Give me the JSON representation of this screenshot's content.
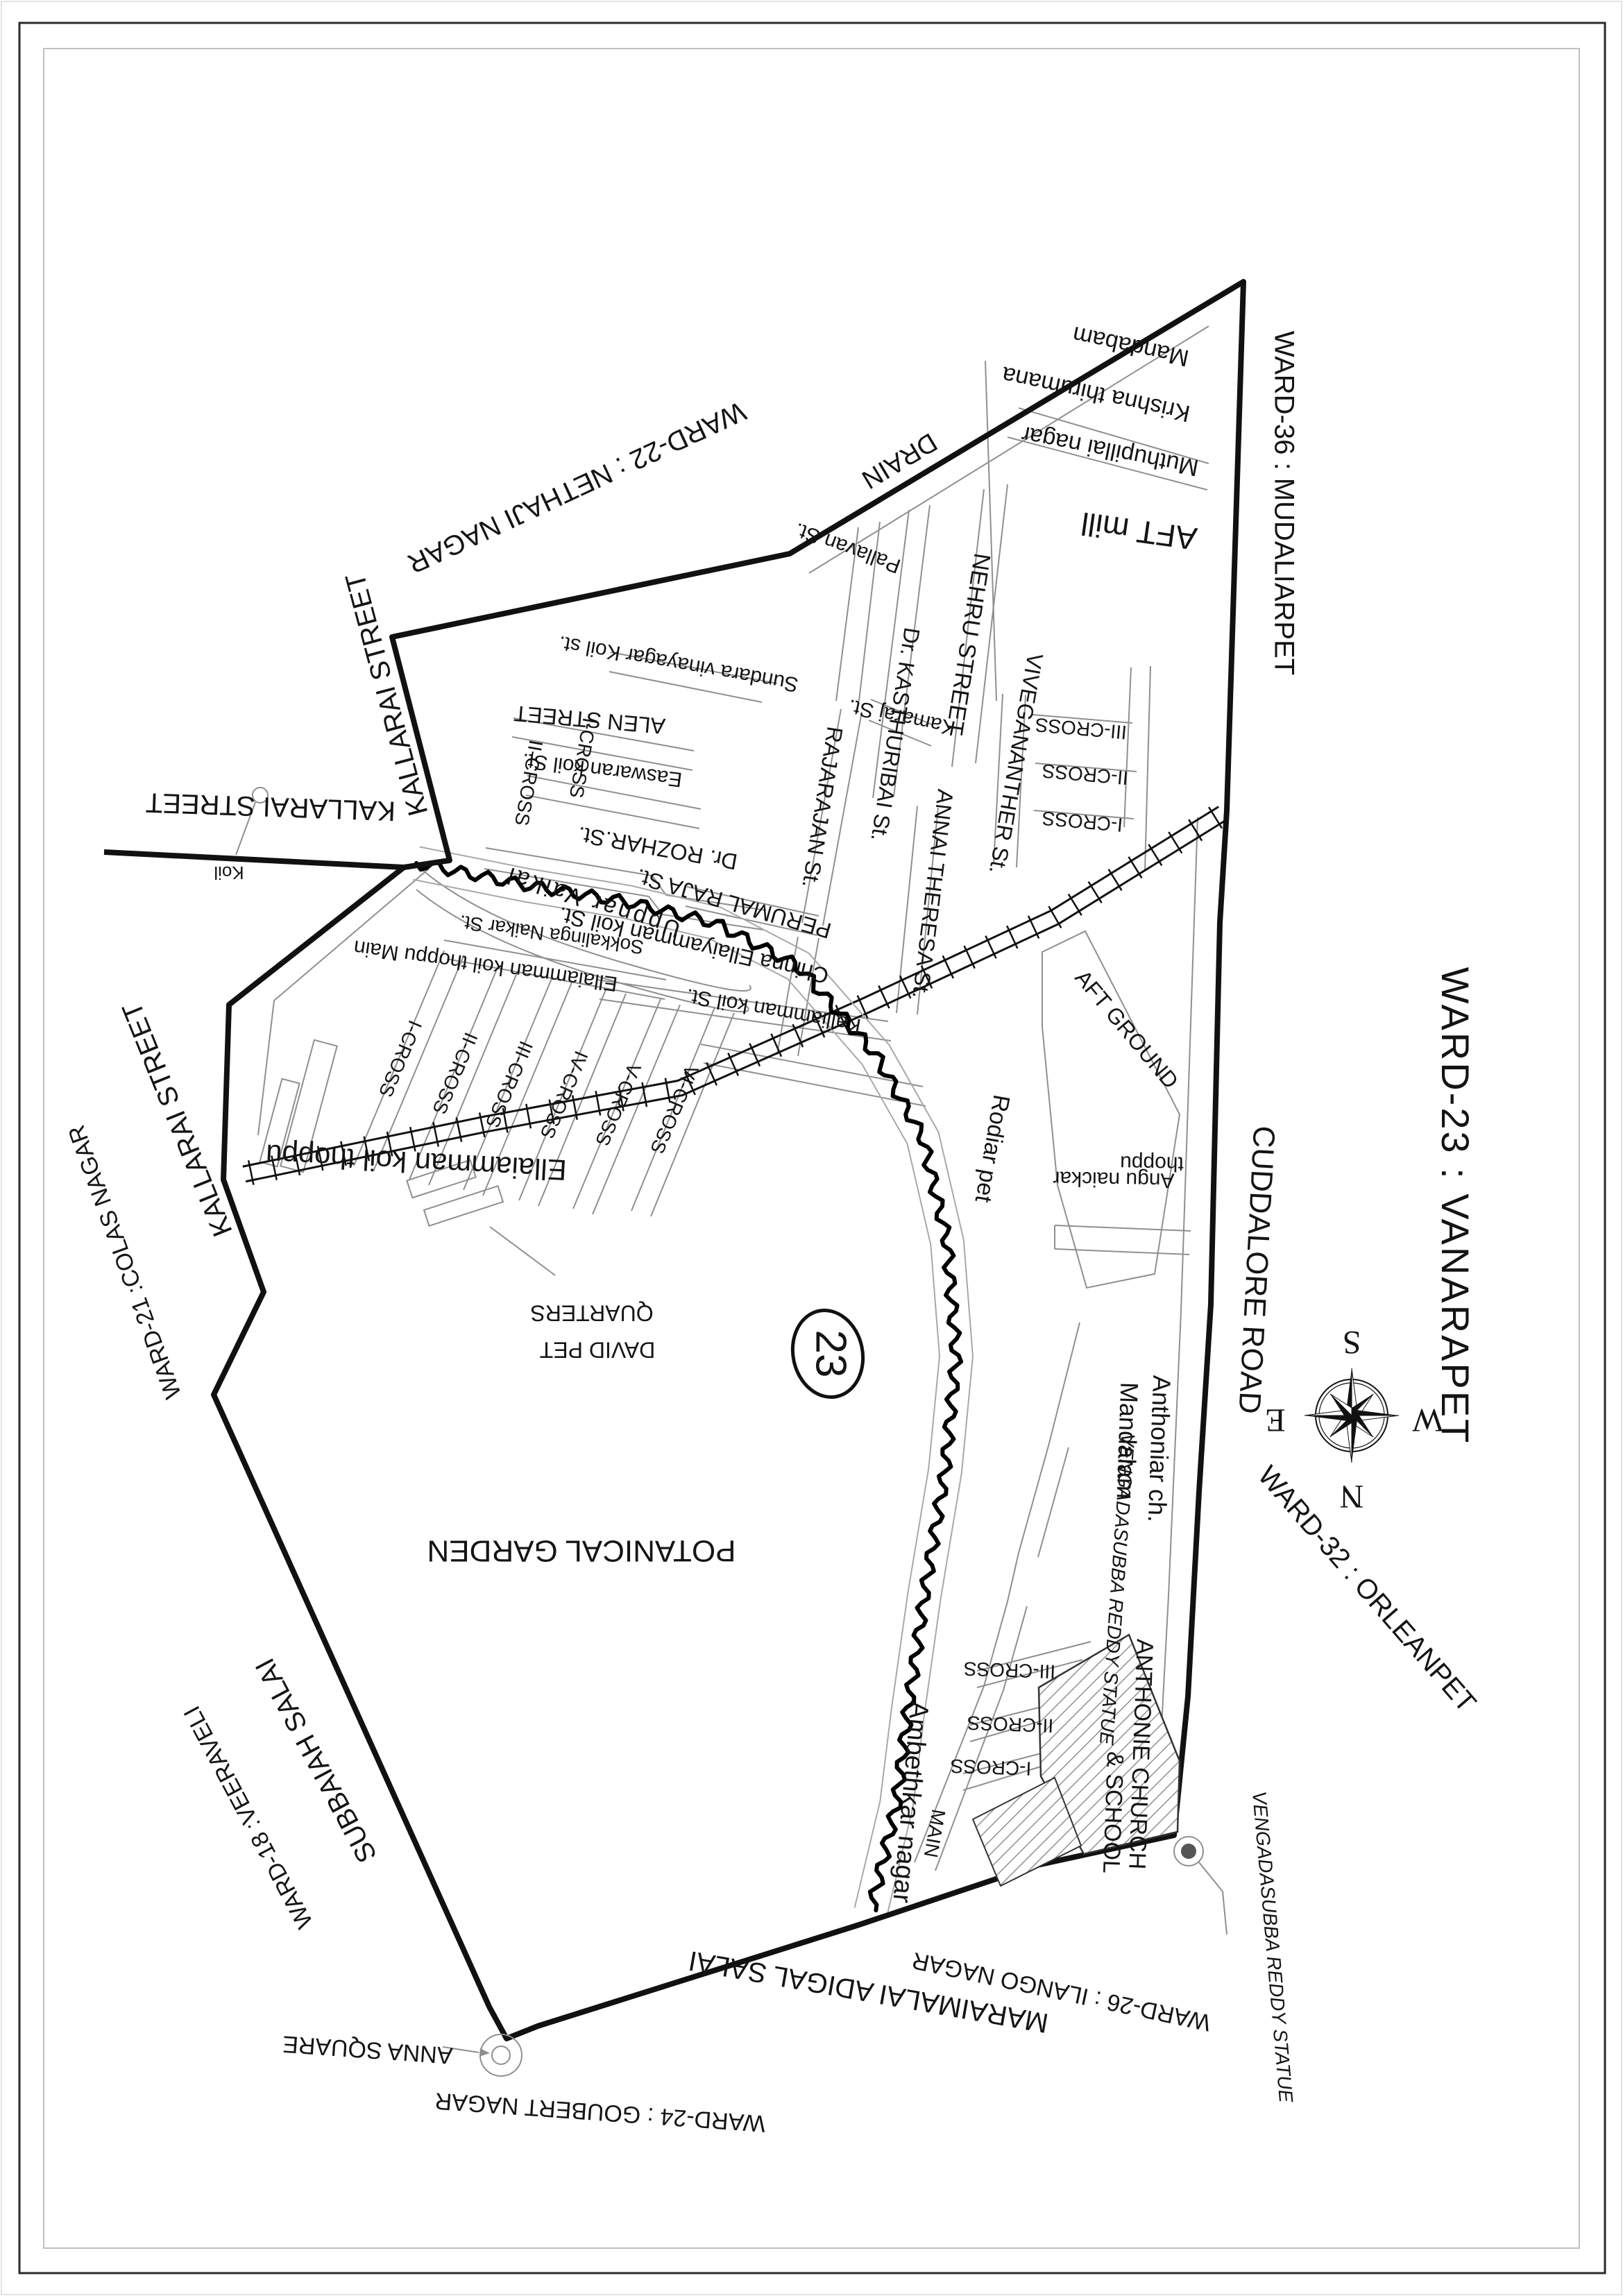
{
  "page": {
    "title": "WARD-23 : VANARAPET"
  },
  "labels": {
    "ward_title": "WARD-23 : VANARAPET",
    "badge": "23",
    "compass": {
      "n": "N",
      "s": "S",
      "e": "E",
      "w": "W"
    },
    "wards": {
      "ward36": "WARD-36 : MUDALIARPET",
      "ward22": "WARD-22 : NETHAJI NAGAR",
      "ward21": "WARD-21 :COLAS NAGAR",
      "ward18": "WARD-18 :VEERAVELI",
      "ward24": "WARD-24 : GOUBERT NAGAR",
      "ward26": "WARD-26 : ILANGO NAGAR",
      "ward32": "WARD-32 : ORLEANPET"
    },
    "roads": {
      "kallarai_ne": "KALLARAI STREET",
      "kallarai_west": "KALLARAI STREET",
      "kallarai_sw": "KALLARAI STREET",
      "subbaiah": "SUBBAIAH SALAI",
      "maraimalai": "MARAIMALAI ADIGAL SALAI",
      "cuddalore": "CUDDALORE ROAD",
      "drain": "DRAIN"
    },
    "streets": {
      "pallavan": "Pallavan St.",
      "nehru": "NEHRU STREET",
      "kasthuribai": "Dr. KASTHURIBAI St.",
      "rajarajan": "RAJARAJAN St.",
      "kamaraj": "Kamaraj St.",
      "sundara": "Sundara vinayagar Koil st.",
      "alen": "ALEN STREET",
      "easwaran": "Easwaran koil St.",
      "rozhar": "Dr. ROZHAR.St.",
      "sokkalinga": "Sokkalinga Naikar St.",
      "perumal": "PERUMAL RAJA St.",
      "chinna": "Chinna Ellaiyamman koil St.",
      "kalliamman": "Kalliamman koil St.",
      "vivegananther": "VIVEGANANTHER St.",
      "annai": "ANNAI THERESA St.",
      "cross_tl_1": "I-CROSS",
      "cross_tl_2": "II-CROSS",
      "cross_v1": "I-CROSS",
      "cross_v2": "II-CROSS",
      "cross_v3": "III-CROSS",
      "uppnar": "Uppnar Vaikal",
      "ekt_main": "Ellaiamman koil thoppu    Main",
      "fan_cross_1": "I-CROSS",
      "fan_cross_2": "II-CROSS",
      "fan_cross_3": "III-CROSS",
      "fan_cross_4": "IV-CROSS",
      "fan_cross_5": "V-CROSS",
      "fan_cross_6": "VI-CROSS",
      "amb_main": "MAIN",
      "amb_cross_1": "I-CROSS",
      "amb_cross_2": "II-CROSS",
      "amb_cross_3": "III-CROSS"
    },
    "areas": {
      "krishna_1": "Krishna thirumana",
      "krishna_2": "Mandabam",
      "muthupillai": "Muthupillai nagar",
      "aft_mill": "AFT mill",
      "aft_ground": "AFT GROUND",
      "angu_1": "Angu naickar",
      "angu_2": "thoppu",
      "rodiar": "Rodiar pet",
      "ekt": "Ellaiamman koil thoppu",
      "david_1": "DAVID PET",
      "david_2": "QUARTERS",
      "potanical": "POTANICAL GARDEN",
      "ambethkar": "Ambethkar nagar"
    },
    "landmarks": {
      "koil": "Koil",
      "anna_square": "ANNA SQUARE",
      "anthoniar_1": "Anthoniar ch.",
      "anthoniar_2": "Mandalam",
      "anthonie_1": "ANTHONIE CHURCH",
      "anthonie_2": "& SCHOOL",
      "venga_top": "VENGADASUBBA REDDY STATUE",
      "venga_bottom": "VENGADASUBBA REDDY STATUE"
    }
  }
}
